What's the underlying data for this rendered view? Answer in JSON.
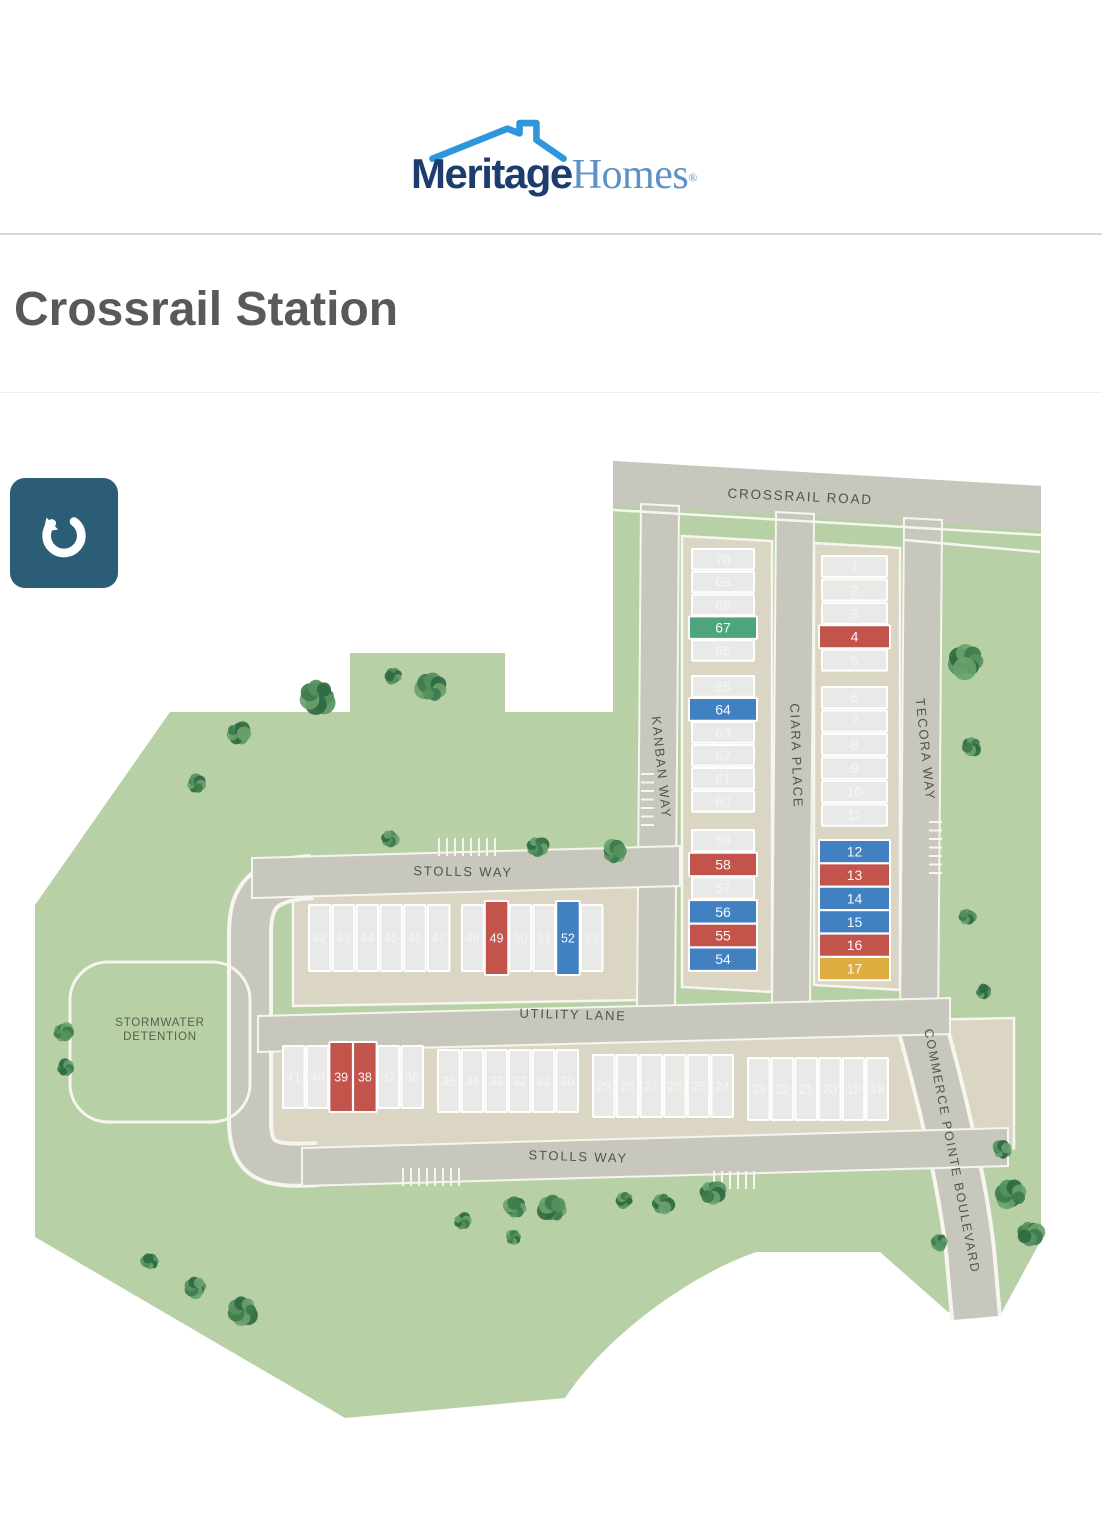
{
  "header": {
    "brand_primary": "Meritage",
    "brand_secondary": "Homes",
    "registered": "®"
  },
  "page": {
    "title": "Crossrail Station"
  },
  "controls": {
    "reset_button": "reset-map-view"
  },
  "map": {
    "colors": {
      "site_green": "#b8d0a5",
      "road": "#c8c7bd",
      "pad": "#dbd5c3",
      "curb": "#f6f5ef",
      "label": "#53544a",
      "button": "#2b5d77",
      "lot_available": "#e9e9e7",
      "lot_red": "#c2544c",
      "lot_blue": "#4181c2",
      "lot_green": "#4da57c",
      "lot_yellow": "#ddad3f"
    },
    "streets": [
      {
        "name": "CROSSRAIL ROAD",
        "x": 800,
        "y": 501,
        "rotate": 2.6,
        "size": 13.5
      },
      {
        "name": "KANBAN WAY",
        "x": 657,
        "y": 768,
        "rotate": 84,
        "size": 13
      },
      {
        "name": "CIARA PLACE",
        "x": 792,
        "y": 756,
        "rotate": 88,
        "size": 13
      },
      {
        "name": "TECORA WAY",
        "x": 921,
        "y": 750,
        "rotate": 84,
        "size": 13
      },
      {
        "name": "STOLLS WAY",
        "x": 463,
        "y": 876,
        "rotate": 1,
        "size": 13
      },
      {
        "name": "UTILITY LANE",
        "x": 573,
        "y": 1019,
        "rotate": 1.5,
        "size": 13
      },
      {
        "name": "STOLLS WAY",
        "x": 578,
        "y": 1161,
        "rotate": 2,
        "size": 13
      },
      {
        "name": "COMMERCE POINTE BOULEVARD",
        "x": 948,
        "y": 1152,
        "rotate": 79,
        "size": 12.5
      }
    ],
    "areas": [
      {
        "id": "stormwater-detention",
        "lines": [
          "STORMWATER",
          "DETENTION"
        ],
        "x": 160,
        "y": 1026
      }
    ],
    "lot_groups": [
      {
        "id": "kanban-east-north",
        "orient": "rows",
        "x": 692,
        "y": 549,
        "w": 62,
        "h": 20.5,
        "step": 22.8,
        "lots": [
          {
            "n": "70"
          },
          {
            "n": "69"
          },
          {
            "n": "68"
          },
          {
            "n": "67",
            "c": "green"
          },
          {
            "n": "66"
          }
        ]
      },
      {
        "id": "kanban-east-mid",
        "orient": "rows",
        "x": 692,
        "y": 676,
        "w": 62,
        "h": 20.8,
        "step": 23.0,
        "lots": [
          {
            "n": "65"
          },
          {
            "n": "64",
            "c": "blue"
          },
          {
            "n": "63"
          },
          {
            "n": "62"
          },
          {
            "n": "61"
          },
          {
            "n": "60"
          }
        ]
      },
      {
        "id": "kanban-east-south",
        "orient": "rows",
        "x": 692,
        "y": 830,
        "w": 62,
        "h": 21.4,
        "step": 23.7,
        "lots": [
          {
            "n": "59"
          },
          {
            "n": "58",
            "c": "red"
          },
          {
            "n": "57"
          },
          {
            "n": "56",
            "c": "blue"
          },
          {
            "n": "55",
            "c": "red"
          },
          {
            "n": "54",
            "c": "blue"
          }
        ]
      },
      {
        "id": "tecora-west-north",
        "orient": "rows",
        "x": 822,
        "y": 556,
        "w": 65,
        "h": 21,
        "step": 23.4,
        "lots": [
          {
            "n": "1"
          },
          {
            "n": "2"
          },
          {
            "n": "3"
          },
          {
            "n": "4",
            "c": "red"
          },
          {
            "n": "5"
          }
        ]
      },
      {
        "id": "tecora-west-mid",
        "orient": "rows",
        "x": 822,
        "y": 687,
        "w": 65,
        "h": 21.2,
        "step": 23.5,
        "lots": [
          {
            "n": "6"
          },
          {
            "n": "7"
          },
          {
            "n": "8"
          },
          {
            "n": "9"
          },
          {
            "n": "10"
          },
          {
            "n": "11"
          }
        ]
      },
      {
        "id": "tecora-west-south",
        "orient": "rows",
        "x": 822,
        "y": 841,
        "w": 65,
        "h": 21.2,
        "step": 23.4,
        "lots": [
          {
            "n": "12",
            "c": "blue"
          },
          {
            "n": "13",
            "c": "red"
          },
          {
            "n": "14",
            "c": "blue"
          },
          {
            "n": "15",
            "c": "blue"
          },
          {
            "n": "16",
            "c": "red"
          },
          {
            "n": "17",
            "c": "yellow"
          }
        ]
      },
      {
        "id": "stolls-row-west",
        "orient": "cols",
        "x": 309,
        "y": 905,
        "w": 21.5,
        "h": 66,
        "step": 23.8,
        "lots": [
          {
            "n": "42"
          },
          {
            "n": "43"
          },
          {
            "n": "44"
          },
          {
            "n": "45"
          },
          {
            "n": "46"
          },
          {
            "n": "47"
          }
        ]
      },
      {
        "id": "stolls-row-east",
        "orient": "cols",
        "x": 462,
        "y": 905,
        "w": 21.5,
        "h": 66,
        "step": 23.8,
        "lots": [
          {
            "n": "48"
          },
          {
            "n": "49",
            "c": "red"
          },
          {
            "n": "50"
          },
          {
            "n": "51"
          },
          {
            "n": "52",
            "c": "blue"
          },
          {
            "n": "53"
          }
        ]
      },
      {
        "id": "utility-row-1",
        "orient": "cols",
        "x": 283,
        "y": 1046,
        "w": 21.5,
        "h": 62,
        "step": 23.7,
        "lots": [
          {
            "n": "41"
          },
          {
            "n": "40"
          },
          {
            "n": "39",
            "c": "red"
          },
          {
            "n": "38",
            "c": "red"
          },
          {
            "n": "37"
          },
          {
            "n": "36"
          }
        ]
      },
      {
        "id": "utility-row-2",
        "orient": "cols",
        "x": 438,
        "y": 1050,
        "w": 21.5,
        "h": 62,
        "step": 23.7,
        "lots": [
          {
            "n": "35"
          },
          {
            "n": "34"
          },
          {
            "n": "33"
          },
          {
            "n": "32"
          },
          {
            "n": "31"
          },
          {
            "n": "30"
          }
        ]
      },
      {
        "id": "utility-row-3",
        "orient": "cols",
        "x": 593,
        "y": 1055,
        "w": 21.5,
        "h": 62,
        "step": 23.7,
        "lots": [
          {
            "n": "29"
          },
          {
            "n": "28"
          },
          {
            "n": "27"
          },
          {
            "n": "26"
          },
          {
            "n": "25"
          },
          {
            "n": "24"
          }
        ]
      },
      {
        "id": "utility-row-4",
        "orient": "cols",
        "x": 748,
        "y": 1058,
        "w": 21.5,
        "h": 62,
        "step": 23.7,
        "lots": [
          {
            "n": "23"
          },
          {
            "n": "22"
          },
          {
            "n": "21"
          },
          {
            "n": "20"
          },
          {
            "n": "19"
          },
          {
            "n": "18"
          }
        ]
      }
    ],
    "trees": [
      {
        "x": 318,
        "y": 696,
        "r": 17
      },
      {
        "x": 238,
        "y": 733,
        "r": 11
      },
      {
        "x": 196,
        "y": 784,
        "r": 9
      },
      {
        "x": 432,
        "y": 688,
        "r": 14
      },
      {
        "x": 394,
        "y": 676,
        "r": 8
      },
      {
        "x": 390,
        "y": 838,
        "r": 8
      },
      {
        "x": 537,
        "y": 846,
        "r": 10
      },
      {
        "x": 614,
        "y": 852,
        "r": 11
      },
      {
        "x": 866,
        "y": 640,
        "r": 10
      },
      {
        "x": 967,
        "y": 661,
        "r": 16
      },
      {
        "x": 972,
        "y": 746,
        "r": 9
      },
      {
        "x": 967,
        "y": 916,
        "r": 8
      },
      {
        "x": 983,
        "y": 992,
        "r": 7
      },
      {
        "x": 1002,
        "y": 1150,
        "r": 9
      },
      {
        "x": 1012,
        "y": 1194,
        "r": 14
      },
      {
        "x": 940,
        "y": 1242,
        "r": 8
      },
      {
        "x": 1030,
        "y": 1233,
        "r": 12
      },
      {
        "x": 462,
        "y": 1221,
        "r": 8
      },
      {
        "x": 515,
        "y": 1208,
        "r": 10
      },
      {
        "x": 553,
        "y": 1209,
        "r": 13
      },
      {
        "x": 625,
        "y": 1200,
        "r": 8
      },
      {
        "x": 663,
        "y": 1203,
        "r": 10
      },
      {
        "x": 712,
        "y": 1192,
        "r": 12
      },
      {
        "x": 513,
        "y": 1238,
        "r": 7
      },
      {
        "x": 150,
        "y": 1262,
        "r": 8
      },
      {
        "x": 196,
        "y": 1287,
        "r": 10
      },
      {
        "x": 243,
        "y": 1310,
        "r": 14
      },
      {
        "x": 63,
        "y": 1032,
        "r": 9
      },
      {
        "x": 65,
        "y": 1068,
        "r": 8
      }
    ]
  }
}
